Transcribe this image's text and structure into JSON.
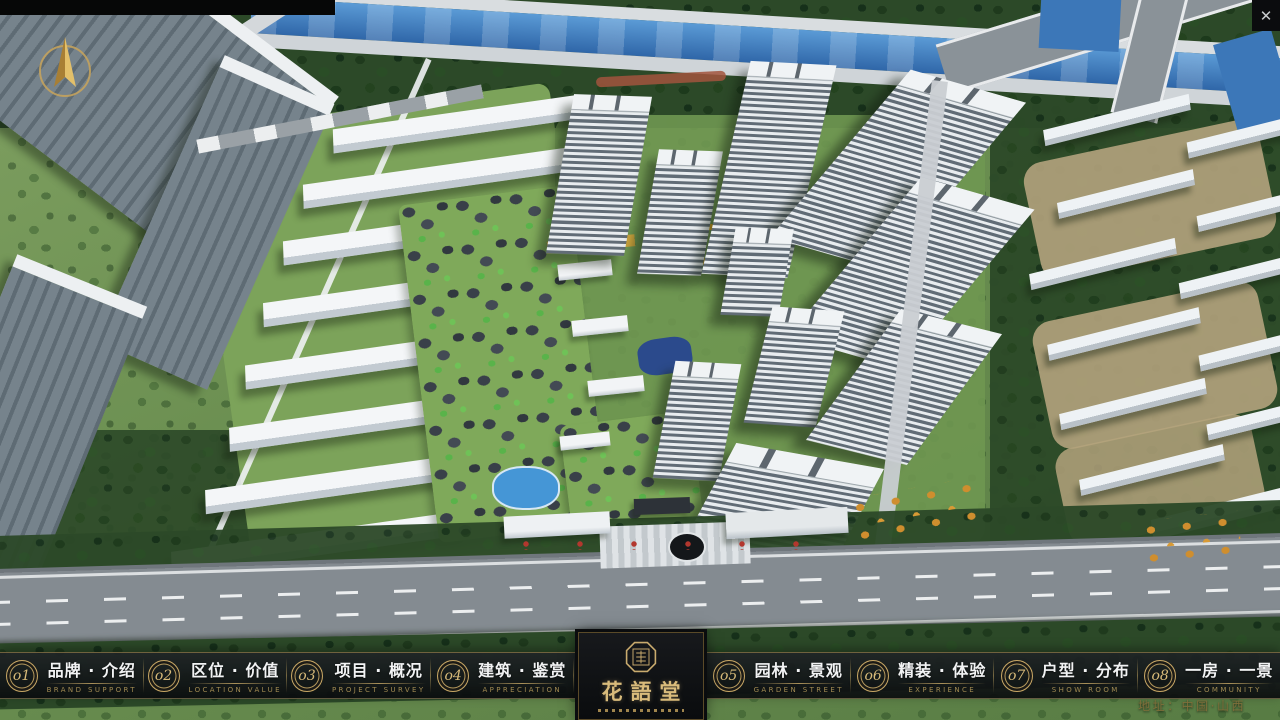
{
  "window": {
    "close_label": "✕"
  },
  "nav": {
    "items": [
      {
        "num": "o1",
        "cn": "品牌 · 介绍",
        "en": "BRAND SUPPORT"
      },
      {
        "num": "o2",
        "cn": "区位 · 价值",
        "en": "LOCATION VALUE"
      },
      {
        "num": "o3",
        "cn": "项目 · 概况",
        "en": "PROJECT SURVEY"
      },
      {
        "num": "o4",
        "cn": "建筑 · 鉴赏",
        "en": "APPRECIATION"
      },
      {
        "num": "o5",
        "cn": "园林 · 景观",
        "en": "GARDEN STREET"
      },
      {
        "num": "o6",
        "cn": "精装 · 体验",
        "en": "EXPERIENCE"
      },
      {
        "num": "o7",
        "cn": "户型 · 分布",
        "en": "SHOW ROOM"
      },
      {
        "num": "o8",
        "cn": "一房 · 一景",
        "en": "COMMUNITY"
      }
    ]
  },
  "logo": {
    "title": "花語堂"
  },
  "footer": {
    "address": "地址：中国·山西"
  },
  "colors": {
    "accent_gold": "#c9ab6e",
    "nav_background": "#12151a",
    "label_white": "#f2f3f4",
    "label_gold": "#a08a52",
    "water_blue": "#3c77b8",
    "foliage_green": "#2f5129"
  }
}
